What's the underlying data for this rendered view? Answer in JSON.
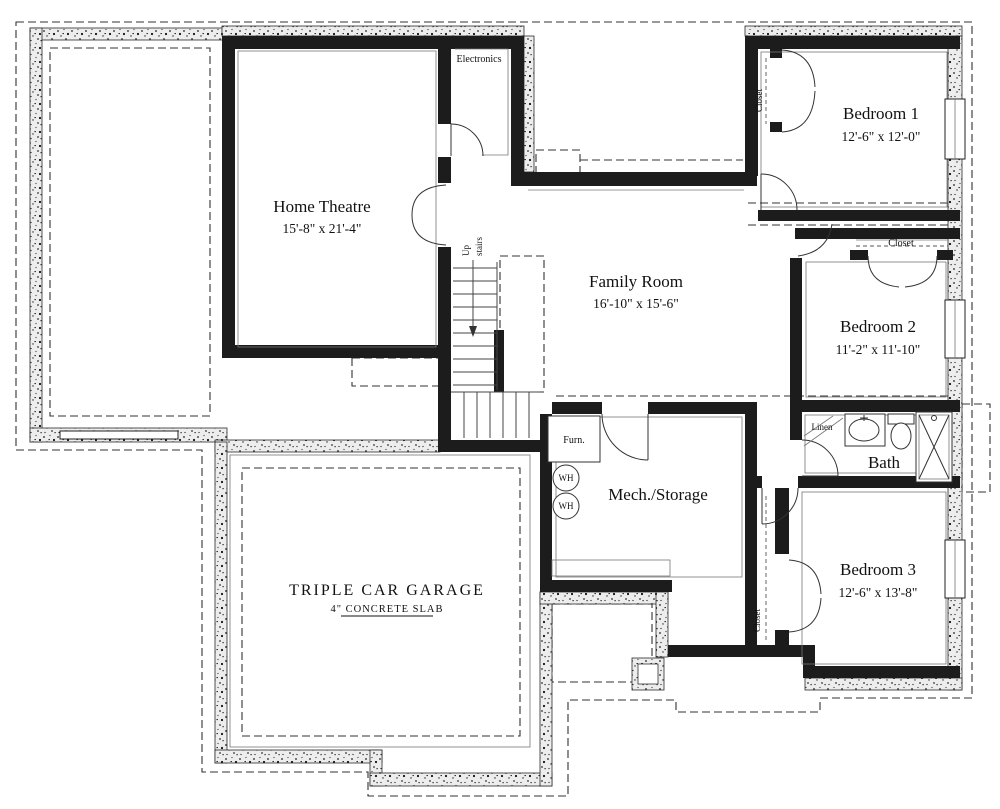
{
  "rooms": {
    "home_theatre": {
      "name": "Home Theatre",
      "dims": "15'-8\" x 21'-4\""
    },
    "family_room": {
      "name": "Family Room",
      "dims": "16'-10\" x 15'-6\""
    },
    "bedroom1": {
      "name": "Bedroom 1",
      "dims": "12'-6\" x 12'-0\""
    },
    "bedroom2": {
      "name": "Bedroom 2",
      "dims": "11'-2\" x 11'-10\""
    },
    "bedroom3": {
      "name": "Bedroom 3",
      "dims": "12'-6\" x 13'-8\""
    },
    "bath": {
      "name": "Bath"
    },
    "mech": {
      "name": "Mech./Storage"
    },
    "garage": {
      "name": "TRIPLE CAR GARAGE",
      "note": "4\" CONCRETE SLAB"
    }
  },
  "labels": {
    "electronics": "Electronics",
    "closet": "Closet",
    "linen": "Linen",
    "furnace": "Furn.",
    "water_heater": "WH",
    "stairs_up": "Up",
    "stairs_word": "stairs"
  },
  "colors": {
    "wall": "#1c1c1c",
    "concrete_base": "#ededed",
    "line": "#333333",
    "paper": "#ffffff"
  }
}
